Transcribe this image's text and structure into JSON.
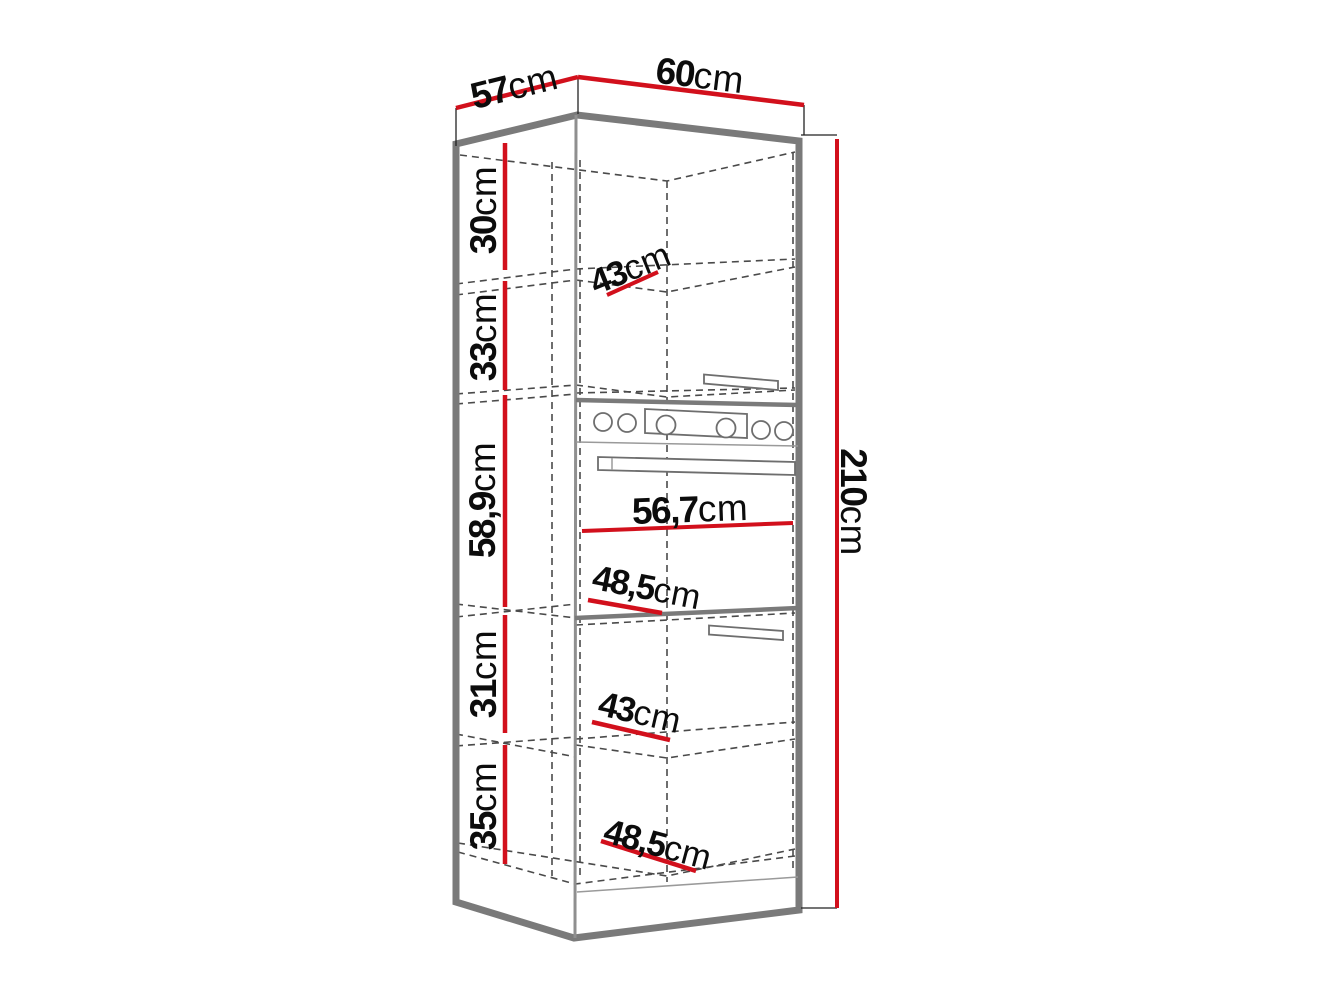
{
  "title": "tall-oven-cabinet-dimension-diagram",
  "unit": "cm",
  "labels": {
    "top_depth": {
      "value": "57",
      "unit": "cm"
    },
    "top_width": {
      "value": "60",
      "unit": "cm"
    },
    "total_height": {
      "value": "210",
      "unit": "cm"
    },
    "left_sections": [
      {
        "value": "30",
        "unit": "cm"
      },
      {
        "value": "33",
        "unit": "cm"
      },
      {
        "value": "58,9",
        "unit": "cm"
      },
      {
        "value": "31",
        "unit": "cm"
      },
      {
        "value": "35",
        "unit": "cm"
      }
    ],
    "interior": [
      {
        "value": "43",
        "unit": "cm"
      },
      {
        "value": "56,7",
        "unit": "cm"
      },
      {
        "value": "48,5",
        "unit": "cm"
      },
      {
        "value": "43",
        "unit": "cm"
      },
      {
        "value": "48,5",
        "unit": "cm"
      }
    ]
  },
  "colors": {
    "dimension_red": "#d2101c",
    "outline_gray": "#7a7a7a",
    "dash_gray": "#4a4a4a",
    "text_black": "#0c0c0c"
  }
}
